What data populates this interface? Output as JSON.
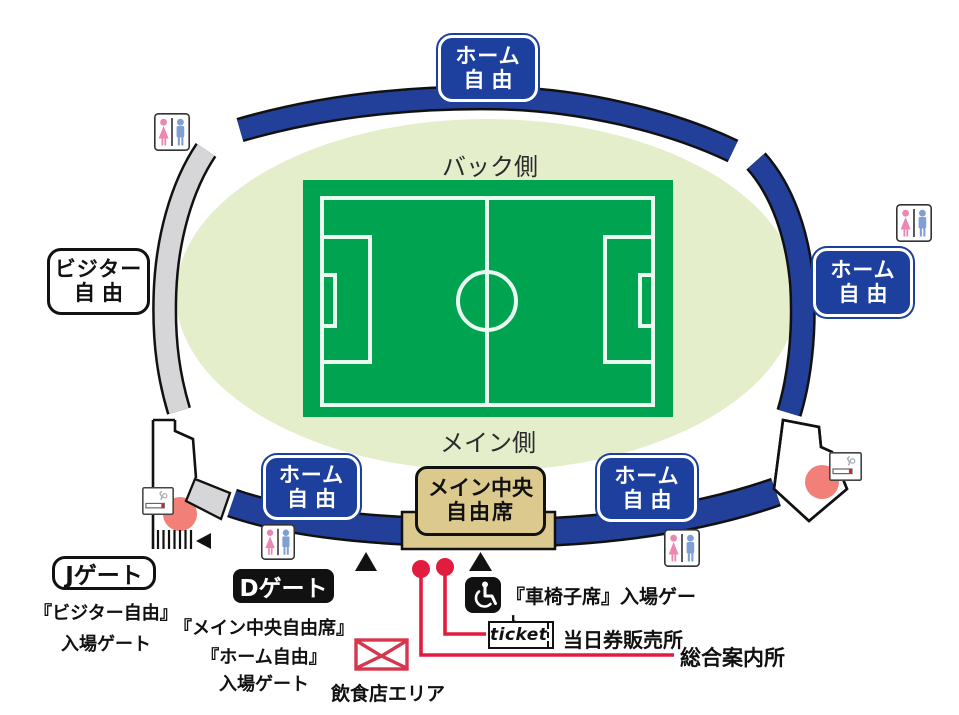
{
  "colors": {
    "band_blue": "#22409a",
    "box_blue": "#1d3f9e",
    "field_green": "#00a350",
    "infield_green": "#e4eecb",
    "stand_gray": "#d6d6d8",
    "tan": "#dcc98e",
    "red": "#e21c3f",
    "salmon": "#f28079",
    "female_pink": "#ee86b3",
    "male_blue": "#7f9fd6"
  },
  "field": {
    "back_side": "バック側",
    "main_side": "メイン側"
  },
  "sections": {
    "home_top": {
      "line1": "ホーム",
      "line2": "自由"
    },
    "home_right": {
      "line1": "ホーム",
      "line2": "自由"
    },
    "home_bottom_left": {
      "line1": "ホーム",
      "line2": "自由"
    },
    "home_bottom_right": {
      "line1": "ホーム",
      "line2": "自由"
    },
    "visitor": {
      "line1": "ビジター",
      "line2": "自由"
    },
    "main_central": {
      "line1": "メイン中央",
      "line2": "自由席"
    }
  },
  "gates": {
    "j": {
      "label": "Jゲート",
      "caption": [
        "『ビジター自由』",
        "入場ゲート"
      ]
    },
    "d": {
      "label": "Dゲート",
      "caption": [
        "『メイン中央自由席』",
        "『ホーム自由』",
        "入場ゲート"
      ]
    },
    "wheelchair_caption": "『車椅子席』入場ゲート"
  },
  "facilities": {
    "ticket_logo": "ticket",
    "same_day_tickets": "当日券販売所",
    "information": "総合案内所",
    "food_area": "飲食店エリア"
  }
}
